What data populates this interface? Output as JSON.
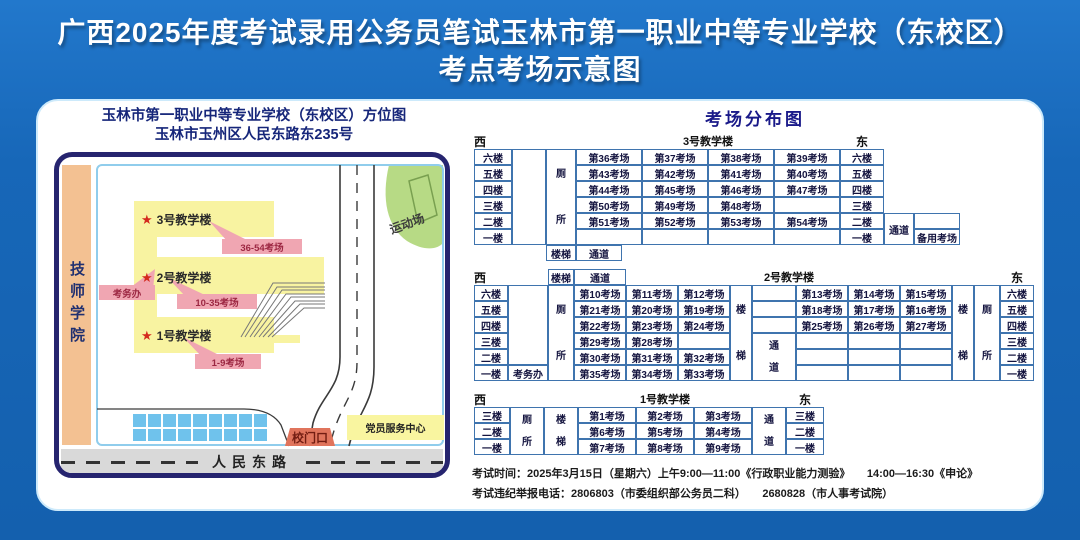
{
  "header": {
    "line1": "广西2025年度考试录用公务员笔试玉林市第一职业中等专业学校（东校区）",
    "line2": "考点考场示意图"
  },
  "map": {
    "title1": "玉林市第一职业中等专业学校（东校区）方位图",
    "title2": "玉林市玉州区人民东路东235号",
    "neighbor": "技师学院",
    "playground": "运动场",
    "gate": "校门口",
    "road": "人民东路",
    "service_center": "党员服务中心",
    "exam_office": "考务办",
    "star": "★",
    "buildings": [
      {
        "name": "3号教学楼",
        "rooms": "36-54考场"
      },
      {
        "name": "2号教学楼",
        "rooms": "10-35考场"
      },
      {
        "name": "1号教学楼",
        "rooms": "1-9考场"
      }
    ],
    "colors": {
      "building": "#f8f3a1",
      "tag": "#f0a6b2",
      "playground": "#b7da85",
      "strip": "#f3c192",
      "gate": "#e0745c"
    }
  },
  "distribution": {
    "title": "考场分布图",
    "tables": [
      {
        "id": "building-3",
        "rowH": 16,
        "cols": [
          38,
          34,
          30,
          66,
          66,
          66,
          66,
          44,
          30,
          46
        ],
        "cells": [
          {
            "r": 1,
            "c": 1,
            "t": "西",
            "h": "w"
          },
          {
            "r": 1,
            "c": 4,
            "cs": 4,
            "t": "3号教学楼",
            "h": "t"
          },
          {
            "r": 1,
            "c": 8,
            "t": "东",
            "h": "e"
          },
          {
            "r": 2,
            "c": 1,
            "t": "六楼"
          },
          {
            "r": 2,
            "c": 2,
            "rs": 6,
            "t": ""
          },
          {
            "r": 2,
            "c": 3,
            "rs": 6,
            "ls": [
              "厕",
              "所"
            ]
          },
          {
            "r": 2,
            "c": 4,
            "t": "第36考场"
          },
          {
            "r": 2,
            "c": 5,
            "t": "第37考场"
          },
          {
            "r": 2,
            "c": 6,
            "t": "第38考场"
          },
          {
            "r": 2,
            "c": 7,
            "t": "第39考场"
          },
          {
            "r": 2,
            "c": 8,
            "t": "六楼"
          },
          {
            "r": 3,
            "c": 1,
            "t": "五楼"
          },
          {
            "r": 3,
            "c": 4,
            "t": "第43考场"
          },
          {
            "r": 3,
            "c": 5,
            "t": "第42考场"
          },
          {
            "r": 3,
            "c": 6,
            "t": "第41考场"
          },
          {
            "r": 3,
            "c": 7,
            "t": "第40考场"
          },
          {
            "r": 3,
            "c": 8,
            "t": "五楼"
          },
          {
            "r": 4,
            "c": 1,
            "t": "四楼"
          },
          {
            "r": 4,
            "c": 4,
            "t": "第44考场"
          },
          {
            "r": 4,
            "c": 5,
            "t": "第45考场"
          },
          {
            "r": 4,
            "c": 6,
            "t": "第46考场"
          },
          {
            "r": 4,
            "c": 7,
            "t": "第47考场"
          },
          {
            "r": 4,
            "c": 8,
            "t": "四楼"
          },
          {
            "r": 5,
            "c": 1,
            "t": "三楼"
          },
          {
            "r": 5,
            "c": 4,
            "t": "第50考场"
          },
          {
            "r": 5,
            "c": 5,
            "t": "第49考场"
          },
          {
            "r": 5,
            "c": 6,
            "t": "第48考场"
          },
          {
            "r": 5,
            "c": 7,
            "t": ""
          },
          {
            "r": 5,
            "c": 8,
            "t": "三楼"
          },
          {
            "r": 6,
            "c": 1,
            "t": "二楼"
          },
          {
            "r": 6,
            "c": 4,
            "t": "第51考场"
          },
          {
            "r": 6,
            "c": 5,
            "t": "第52考场"
          },
          {
            "r": 6,
            "c": 6,
            "t": "第53考场"
          },
          {
            "r": 6,
            "c": 7,
            "t": "第54考场"
          },
          {
            "r": 6,
            "c": 8,
            "t": "二楼"
          },
          {
            "r": 6,
            "c": 9,
            "rs": 2,
            "t": "通道"
          },
          {
            "r": 6,
            "c": 10,
            "t": ""
          },
          {
            "r": 7,
            "c": 1,
            "t": "一楼"
          },
          {
            "r": 7,
            "c": 4,
            "t": ""
          },
          {
            "r": 7,
            "c": 5,
            "t": ""
          },
          {
            "r": 7,
            "c": 6,
            "t": ""
          },
          {
            "r": 7,
            "c": 7,
            "t": ""
          },
          {
            "r": 7,
            "c": 8,
            "t": "一楼"
          },
          {
            "r": 7,
            "c": 10,
            "t": "备用考场"
          },
          {
            "r": 8,
            "c": 3,
            "t": "楼梯"
          },
          {
            "r": 8,
            "c": 4,
            "t": "通道",
            "w": 46
          }
        ]
      },
      {
        "id": "building-2",
        "rowH": 16,
        "cols": [
          34,
          40,
          26,
          52,
          52,
          52,
          22,
          44,
          52,
          52,
          52,
          22,
          26,
          34
        ],
        "cells": [
          {
            "r": 1,
            "c": 1,
            "t": "西",
            "h": "w"
          },
          {
            "r": 1,
            "c": 3,
            "t": "楼梯"
          },
          {
            "r": 1,
            "c": 4,
            "t": "通道"
          },
          {
            "r": 1,
            "c": 5,
            "cs": 7,
            "t": "2号教学楼",
            "h": "t"
          },
          {
            "r": 1,
            "c": 14,
            "t": "东",
            "h": "e"
          },
          {
            "r": 2,
            "c": 1,
            "t": "六楼"
          },
          {
            "r": 2,
            "c": 2,
            "rs": 5,
            "t": ""
          },
          {
            "r": 2,
            "c": 3,
            "rs": 6,
            "ls": [
              "厕",
              "所"
            ]
          },
          {
            "r": 2,
            "c": 4,
            "t": "第10考场"
          },
          {
            "r": 2,
            "c": 5,
            "t": "第11考场"
          },
          {
            "r": 2,
            "c": 6,
            "t": "第12考场"
          },
          {
            "r": 2,
            "c": 7,
            "rs": 6,
            "ls": [
              "楼",
              "梯"
            ]
          },
          {
            "r": 2,
            "c": 8,
            "t": ""
          },
          {
            "r": 2,
            "c": 9,
            "t": "第13考场"
          },
          {
            "r": 2,
            "c": 10,
            "t": "第14考场"
          },
          {
            "r": 2,
            "c": 11,
            "t": "第15考场"
          },
          {
            "r": 2,
            "c": 12,
            "rs": 6,
            "ls": [
              "楼",
              "梯"
            ]
          },
          {
            "r": 2,
            "c": 13,
            "rs": 6,
            "ls": [
              "厕",
              "所"
            ]
          },
          {
            "r": 2,
            "c": 14,
            "t": "六楼"
          },
          {
            "r": 3,
            "c": 1,
            "t": "五楼"
          },
          {
            "r": 3,
            "c": 4,
            "t": "第21考场"
          },
          {
            "r": 3,
            "c": 5,
            "t": "第20考场"
          },
          {
            "r": 3,
            "c": 6,
            "t": "第19考场"
          },
          {
            "r": 3,
            "c": 8,
            "t": ""
          },
          {
            "r": 3,
            "c": 9,
            "t": "第18考场"
          },
          {
            "r": 3,
            "c": 10,
            "t": "第17考场"
          },
          {
            "r": 3,
            "c": 11,
            "t": "第16考场"
          },
          {
            "r": 3,
            "c": 14,
            "t": "五楼"
          },
          {
            "r": 4,
            "c": 1,
            "t": "四楼"
          },
          {
            "r": 4,
            "c": 4,
            "t": "第22考场"
          },
          {
            "r": 4,
            "c": 5,
            "t": "第23考场"
          },
          {
            "r": 4,
            "c": 6,
            "t": "第24考场"
          },
          {
            "r": 4,
            "c": 8,
            "t": ""
          },
          {
            "r": 4,
            "c": 9,
            "t": "第25考场"
          },
          {
            "r": 4,
            "c": 10,
            "t": "第26考场"
          },
          {
            "r": 4,
            "c": 11,
            "t": "第27考场"
          },
          {
            "r": 4,
            "c": 14,
            "t": "四楼"
          },
          {
            "r": 5,
            "c": 1,
            "t": "三楼"
          },
          {
            "r": 5,
            "c": 4,
            "t": "第29考场"
          },
          {
            "r": 5,
            "c": 5,
            "t": "第28考场"
          },
          {
            "r": 5,
            "c": 6,
            "t": ""
          },
          {
            "r": 5,
            "c": 8,
            "rs": 3,
            "ls": [
              "通",
              "道"
            ]
          },
          {
            "r": 5,
            "c": 9,
            "t": ""
          },
          {
            "r": 5,
            "c": 10,
            "t": ""
          },
          {
            "r": 5,
            "c": 11,
            "t": ""
          },
          {
            "r": 5,
            "c": 14,
            "t": "三楼"
          },
          {
            "r": 6,
            "c": 1,
            "t": "二楼"
          },
          {
            "r": 6,
            "c": 4,
            "t": "第30考场"
          },
          {
            "r": 6,
            "c": 5,
            "t": "第31考场"
          },
          {
            "r": 6,
            "c": 6,
            "t": "第32考场"
          },
          {
            "r": 6,
            "c": 9,
            "t": ""
          },
          {
            "r": 6,
            "c": 10,
            "t": ""
          },
          {
            "r": 6,
            "c": 11,
            "t": ""
          },
          {
            "r": 6,
            "c": 14,
            "t": "二楼"
          },
          {
            "r": 7,
            "c": 1,
            "t": "一楼"
          },
          {
            "r": 7,
            "c": 2,
            "t": "考务办"
          },
          {
            "r": 7,
            "c": 4,
            "t": "第35考场"
          },
          {
            "r": 7,
            "c": 5,
            "t": "第34考场"
          },
          {
            "r": 7,
            "c": 6,
            "t": "第33考场"
          },
          {
            "r": 7,
            "c": 9,
            "t": ""
          },
          {
            "r": 7,
            "c": 10,
            "t": ""
          },
          {
            "r": 7,
            "c": 11,
            "t": ""
          },
          {
            "r": 7,
            "c": 14,
            "t": "一楼"
          }
        ]
      },
      {
        "id": "building-1",
        "rowH": 16,
        "cols": [
          36,
          34,
          34,
          58,
          58,
          58,
          34,
          38
        ],
        "cells": [
          {
            "r": 1,
            "c": 1,
            "t": "西",
            "h": "w"
          },
          {
            "r": 1,
            "c": 4,
            "cs": 3,
            "t": "1号教学楼",
            "h": "t"
          },
          {
            "r": 1,
            "c": 8,
            "t": "东",
            "h": "e"
          },
          {
            "r": 2,
            "c": 1,
            "t": "三楼"
          },
          {
            "r": 2,
            "c": 2,
            "rs": 3,
            "ls": [
              "厕",
              "所"
            ]
          },
          {
            "r": 2,
            "c": 3,
            "rs": 3,
            "ls": [
              "楼",
              "梯"
            ]
          },
          {
            "r": 2,
            "c": 4,
            "t": "第1考场"
          },
          {
            "r": 2,
            "c": 5,
            "t": "第2考场"
          },
          {
            "r": 2,
            "c": 6,
            "t": "第3考场"
          },
          {
            "r": 2,
            "c": 7,
            "rs": 3,
            "ls": [
              "通",
              "道"
            ]
          },
          {
            "r": 2,
            "c": 8,
            "t": "三楼"
          },
          {
            "r": 3,
            "c": 1,
            "t": "二楼"
          },
          {
            "r": 3,
            "c": 4,
            "t": "第6考场"
          },
          {
            "r": 3,
            "c": 5,
            "t": "第5考场"
          },
          {
            "r": 3,
            "c": 6,
            "t": "第4考场"
          },
          {
            "r": 3,
            "c": 8,
            "t": "二楼"
          },
          {
            "r": 4,
            "c": 1,
            "t": "一楼"
          },
          {
            "r": 4,
            "c": 4,
            "t": "第7考场"
          },
          {
            "r": 4,
            "c": 5,
            "t": "第8考场"
          },
          {
            "r": 4,
            "c": 6,
            "t": "第9考场"
          },
          {
            "r": 4,
            "c": 8,
            "t": "一楼"
          }
        ]
      }
    ]
  },
  "footer": {
    "line1": "考试时间：2025年3月15日（星期六）上午9:00—11:00《行政职业能力测验》　　14:00—16:30《申论》",
    "line2": "考试违纪举报电话：2806803（市委组织部公务员二科）　　2680828（市人事考试院）"
  }
}
